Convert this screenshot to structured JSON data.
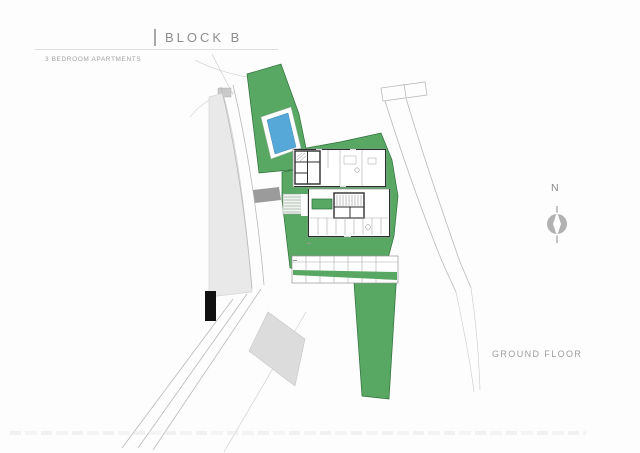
{
  "header": {
    "title": "BLOCK B",
    "subtitle": "3 BEDROOM APARTMENTS"
  },
  "plan": {
    "floor_label": "GROUND FLOOR"
  },
  "compass": {
    "north_label": "N"
  },
  "colors": {
    "green": "#58a763",
    "green_outline": "#2e6f3a",
    "pool_blue": "#55a8d8",
    "parcel": "#e9e9e9",
    "parcel_outline": "#d4d4d4",
    "road": "#b9b9b9",
    "wall": "#2e2e2e",
    "crosswalk": "#9b9b9b",
    "asphalt_patch": "#dcdcdc",
    "marker_black": "#101010",
    "text": "#8d8d8d"
  }
}
